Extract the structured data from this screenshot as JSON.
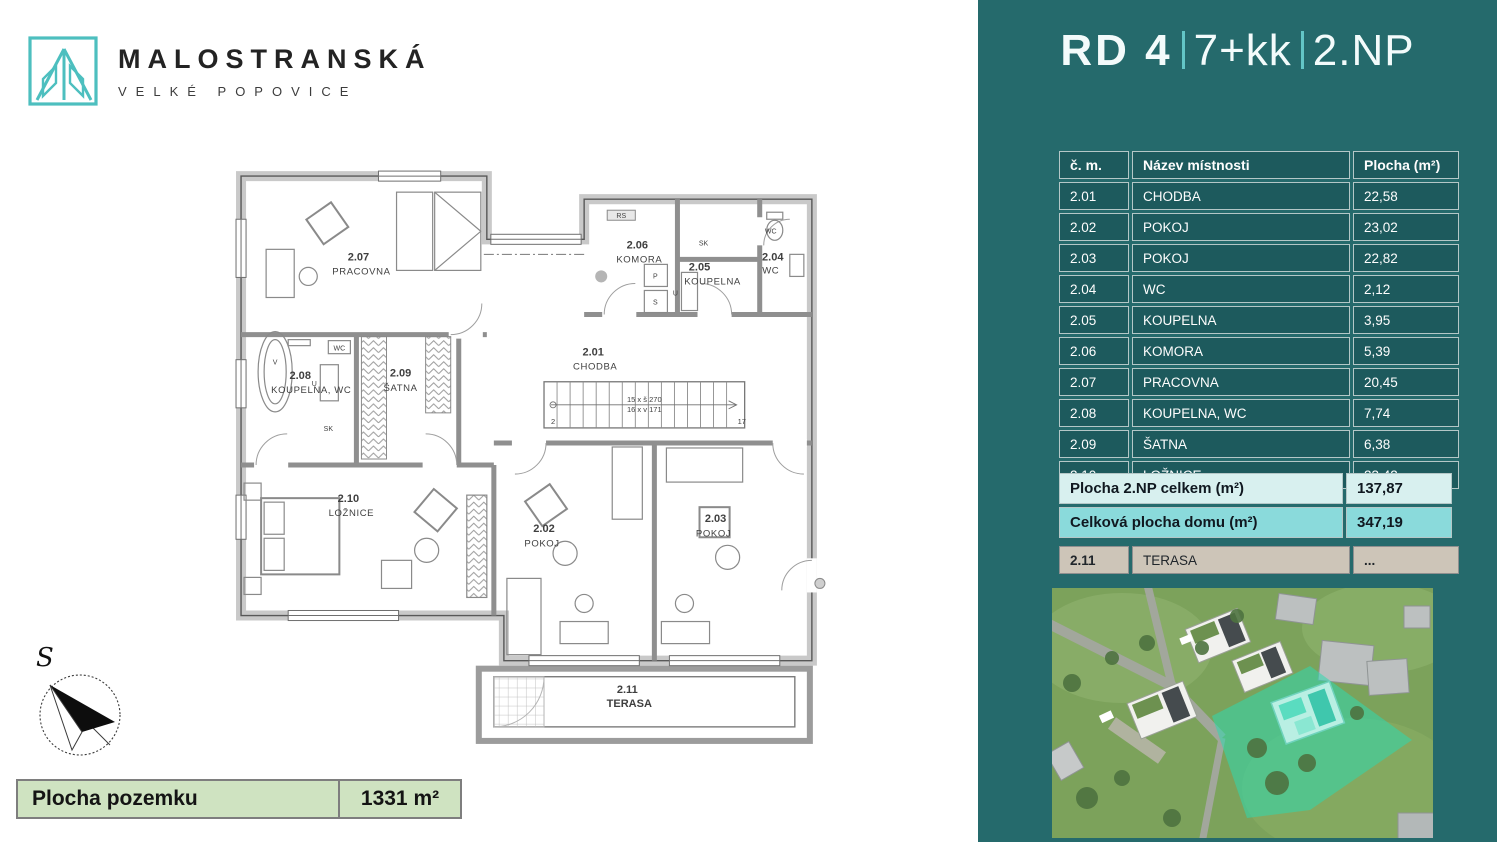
{
  "logo": {
    "title": "MALOSTRANSKÁ",
    "subtitle": "VELKÉ POPOVICE",
    "accent": "#4dbfbf"
  },
  "header": {
    "project": "RD 4",
    "disposition": "7+kk",
    "floor": "2.NP"
  },
  "colors": {
    "panel_bg": "#256a6c",
    "table_cell_bg": "#1d5a5d",
    "table_border": "#b4c7c7",
    "summary_light": "#d8f0ef",
    "summary_cyan": "#8adadb",
    "terrace_tan": "#cdc5b8",
    "plot_green": "#cfe3c1",
    "highlight_teal": "#2fd9ae"
  },
  "room_table": {
    "headers": [
      "č. m.",
      "Název místnosti",
      "Plocha (m²)"
    ],
    "rows": [
      {
        "num": "2.01",
        "name": "CHODBA",
        "area": "22,58"
      },
      {
        "num": "2.02",
        "name": "POKOJ",
        "area": "23,02"
      },
      {
        "num": "2.03",
        "name": "POKOJ",
        "area": "22,82"
      },
      {
        "num": "2.04",
        "name": "WC",
        "area": "2,12"
      },
      {
        "num": "2.05",
        "name": "KOUPELNA",
        "area": "3,95"
      },
      {
        "num": "2.06",
        "name": "KOMORA",
        "area": "5,39"
      },
      {
        "num": "2.07",
        "name": "PRACOVNA",
        "area": "20,45"
      },
      {
        "num": "2.08",
        "name": "KOUPELNA, WC",
        "area": "7,74"
      },
      {
        "num": "2.09",
        "name": "ŠATNA",
        "area": "6,38"
      },
      {
        "num": "2.10",
        "name": "LOŽNICE",
        "area": "23,42"
      }
    ]
  },
  "summary": {
    "rows": [
      {
        "label": "Plocha 2.NP celkem (m²)",
        "value": "137,87"
      },
      {
        "label": "Celková plocha domu (m²)",
        "value": "347,19"
      }
    ]
  },
  "terrace_row": {
    "num": "2.11",
    "name": "TERASA",
    "value": "..."
  },
  "plot": {
    "label": "Plocha pozemku",
    "value": "1331 m²"
  },
  "compass": {
    "north_label": "S"
  },
  "floorplan": {
    "rooms": [
      {
        "number": "2.01",
        "name": "CHODBA"
      },
      {
        "number": "2.02",
        "name": "POKOJ"
      },
      {
        "number": "2.03",
        "name": "POKOJ"
      },
      {
        "number": "2.04",
        "name": "WC"
      },
      {
        "number": "2.05",
        "name": "KOUPELNA"
      },
      {
        "number": "2.06",
        "name": "KOMORA"
      },
      {
        "number": "2.07",
        "name": "PRACOVNA"
      },
      {
        "number": "2.08",
        "name": "KOUPELNA, WC"
      },
      {
        "number": "2.09",
        "name": "ŠATNA"
      },
      {
        "number": "2.10",
        "name": "LOŽNICE"
      },
      {
        "number": "2.11",
        "name": "TERASA"
      }
    ],
    "annotations": {
      "rs": "RS",
      "sk_top": "SK",
      "sk_bath": "SK",
      "wc_small": "WC",
      "bath_v": "V",
      "appliance_u1": "U",
      "appliance_u2": "U",
      "washer_p": "P",
      "dryer_s": "S",
      "stair_line1": "15 x š 270",
      "stair_line2": "16 x v 171",
      "stair_first": "2",
      "stair_last": "17"
    }
  }
}
